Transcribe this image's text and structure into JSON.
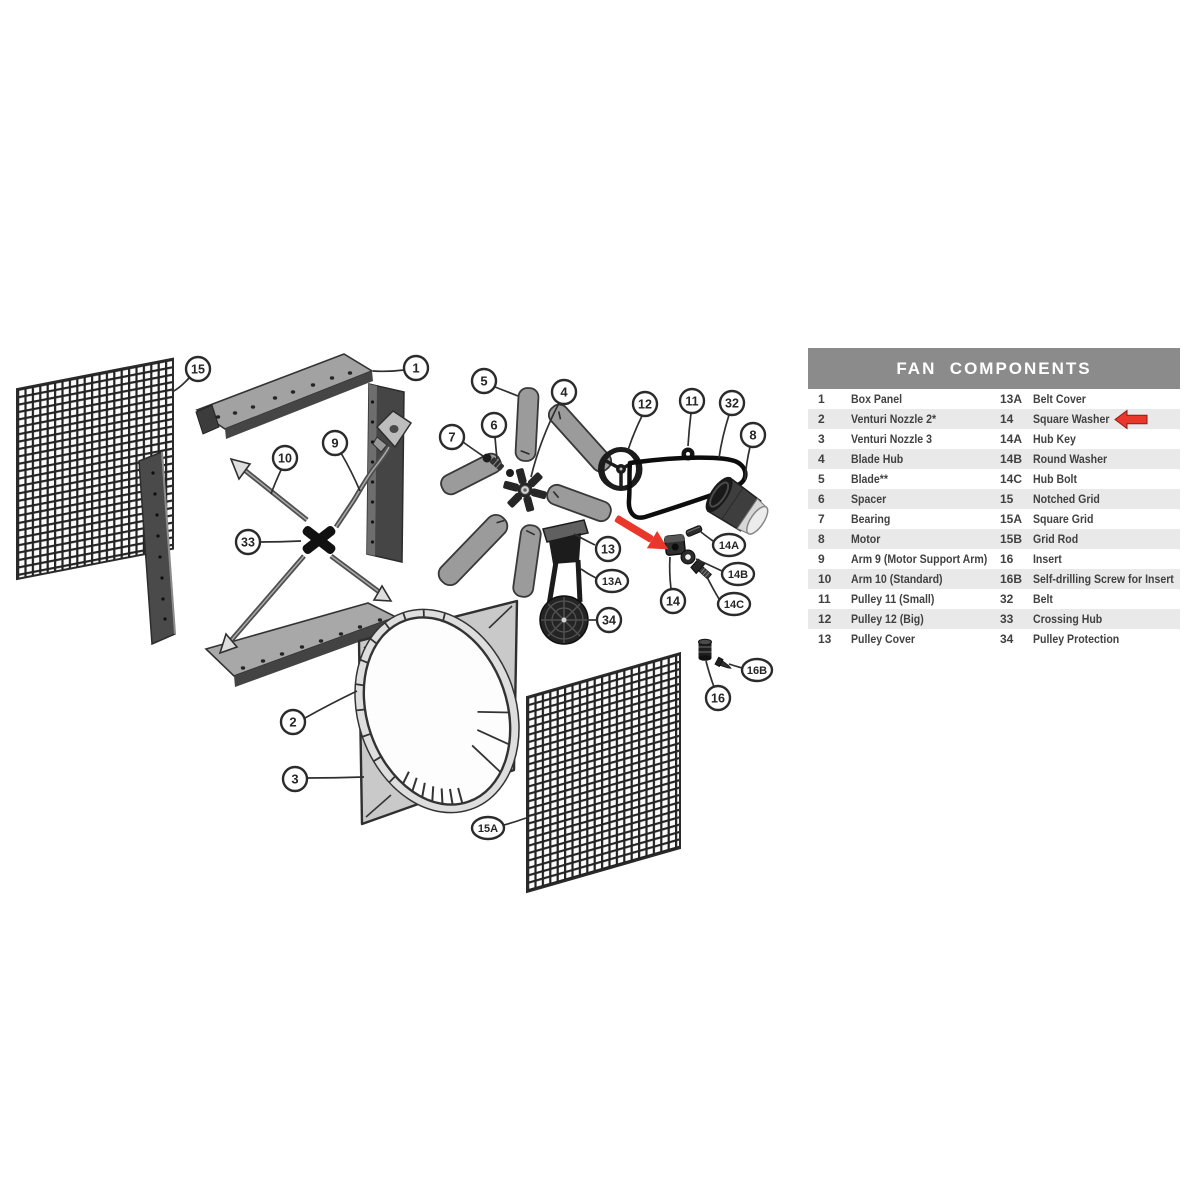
{
  "table": {
    "title": "FAN  COMPONENTS",
    "left_rows": [
      {
        "num": "1",
        "name": "Box Panel"
      },
      {
        "num": "2",
        "name": "Venturi Nozzle 2*"
      },
      {
        "num": "3",
        "name": "Venturi Nozzle 3"
      },
      {
        "num": "4",
        "name": "Blade Hub"
      },
      {
        "num": "5",
        "name": "Blade**"
      },
      {
        "num": "6",
        "name": "Spacer"
      },
      {
        "num": "7",
        "name": "Bearing"
      },
      {
        "num": "8",
        "name": "Motor"
      },
      {
        "num": "9",
        "name": "Arm 9 (Motor Support Arm)"
      },
      {
        "num": "10",
        "name": "Arm 10 (Standard)"
      },
      {
        "num": "11",
        "name": "Pulley 11 (Small)"
      },
      {
        "num": "12",
        "name": "Pulley 12 (Big)"
      },
      {
        "num": "13",
        "name": "Pulley Cover"
      }
    ],
    "right_rows": [
      {
        "num": "13A",
        "name": "Belt Cover"
      },
      {
        "num": "14",
        "name": "Square Washer"
      },
      {
        "num": "14A",
        "name": "Hub Key"
      },
      {
        "num": "14B",
        "name": "Round Washer"
      },
      {
        "num": "14C",
        "name": "Hub Bolt"
      },
      {
        "num": "15",
        "name": "Notched Grid"
      },
      {
        "num": "15A",
        "name": "Square Grid"
      },
      {
        "num": "15B",
        "name": "Grid Rod"
      },
      {
        "num": "16",
        "name": "Insert"
      },
      {
        "num": "16B",
        "name": "Self-drilling Screw for Insert"
      },
      {
        "num": "32",
        "name": "Belt"
      },
      {
        "num": "33",
        "name": "Crossing Hub"
      },
      {
        "num": "34",
        "name": "Pulley Protection"
      }
    ],
    "highlighted_row": {
      "num": "14",
      "name": "Square Washer"
    }
  },
  "callout_labels": {
    "15": "15",
    "1": "1",
    "5": "5",
    "4": "4",
    "12": "12",
    "11": "11",
    "32": "32",
    "8": "8",
    "7": "7",
    "6": "6",
    "9": "9",
    "10": "10",
    "33": "33",
    "13": "13",
    "13A": "13A",
    "34": "34",
    "14A": "14A",
    "14B": "14B",
    "14": "14",
    "14C": "14C",
    "16B": "16B",
    "16": "16",
    "2": "2",
    "3": "3",
    "15A": "15A"
  },
  "colors": {
    "table_header_bg": "#8b8b8b",
    "table_row_alt_bg": "#eae9e9",
    "table_text": "#414141",
    "arrow_red": "#ea372b",
    "diagram_line": "#2b2b2b"
  }
}
